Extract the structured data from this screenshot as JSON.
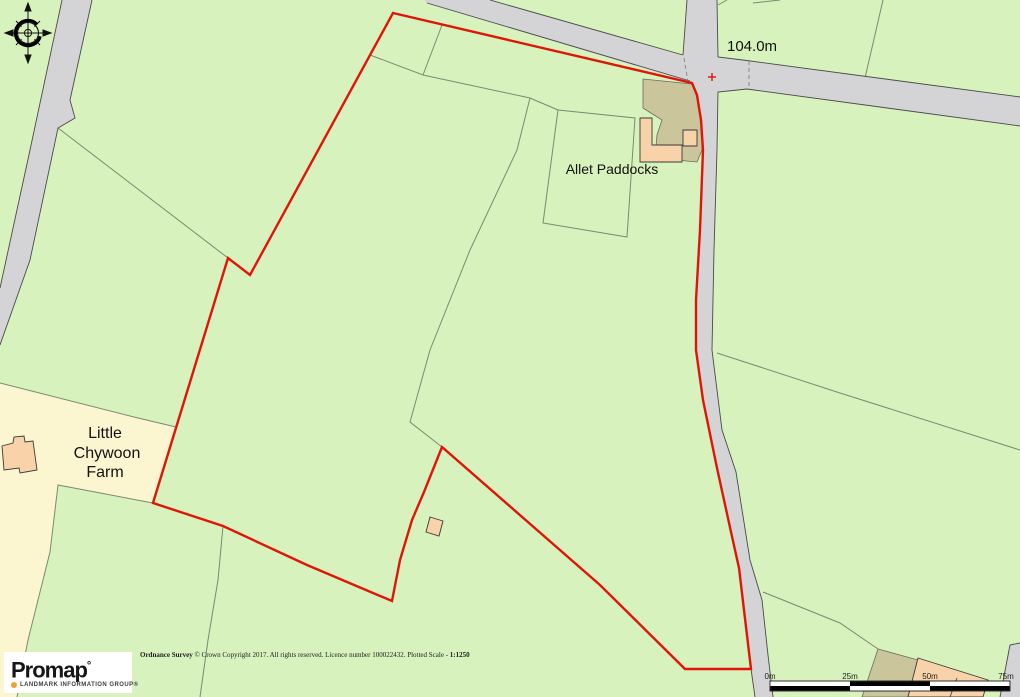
{
  "colors": {
    "field_green": "#d7f2bc",
    "road_gray": "#d4d3d6",
    "road_casing": "#4a4a4a",
    "field_line": "#7c8a70",
    "boundary_red": "#e01507",
    "cream": "#fbf5d0",
    "peach": "#f8d2a8",
    "khaki": "#cbc59c",
    "building_outline": "#3a3a3a",
    "text_color": "#121212",
    "accent_orange": "#f0a030"
  },
  "labels": {
    "spot_height": "104.0m",
    "allet_paddocks": "Allet Paddocks",
    "farm_lines": [
      "Little",
      "Chywoon",
      "Farm"
    ]
  },
  "scale_bar": {
    "labels": [
      "0m",
      "25m",
      "50m",
      "75m"
    ]
  },
  "attribution": {
    "prefix_bold": "Ordnance Survey",
    "body": " © Crown Copyright 2017. All rights reserved. Licence number 100022432. Plotted Scale -  ",
    "scale_bold": "1:1250"
  },
  "logo": {
    "brand": "Promap",
    "mark": "°",
    "tagline": "LANDMARK INFORMATION GROUP®"
  }
}
